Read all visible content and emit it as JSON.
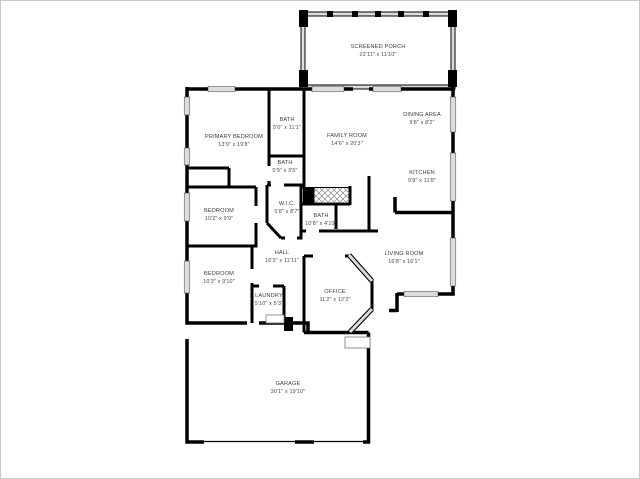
{
  "floorplan": {
    "colors": {
      "wall": "#000000",
      "window": "#dcdcdc",
      "hatch": "#888888",
      "page_border": "#c9c9c9",
      "label_text": "#3d3d3d"
    },
    "rooms": [
      {
        "name": "SCREENED PORCH",
        "dims": "23'11\" x 11'10\""
      },
      {
        "name": "PRIMARY BEDROOM",
        "dims": "13'9\" x 19'8\""
      },
      {
        "name": "BATH",
        "dims": "5'0\" x 11'1\""
      },
      {
        "name": "BATH",
        "dims": "5'9\" x 3'5\""
      },
      {
        "name": "FAMILY ROOM",
        "dims": "14'6\" x 20'3\""
      },
      {
        "name": "DINING AREA",
        "dims": "9'8\" x 8'2\""
      },
      {
        "name": "KITCHEN",
        "dims": "9'8\" x 11'8\""
      },
      {
        "name": "BEDROOM",
        "dims": "10'2\" x 9'9\""
      },
      {
        "name": "W.I.C.",
        "dims": "5'8\" x 8'7\""
      },
      {
        "name": "BATH",
        "dims": "10'8\" x 4'10\""
      },
      {
        "name": "HALL",
        "dims": "16'3\" x 11'11\""
      },
      {
        "name": "BEDROOM",
        "dims": "10'3\" x 9'10\""
      },
      {
        "name": "LAUNDRY",
        "dims": "5'10\" x 5'3\""
      },
      {
        "name": "OFFICE",
        "dims": "11'2\" x 12'2\""
      },
      {
        "name": "LIVING ROOM",
        "dims": "16'8\" x 16'1\""
      },
      {
        "name": "GARAGE",
        "dims": "30'1\" x 19'10\""
      }
    ]
  }
}
